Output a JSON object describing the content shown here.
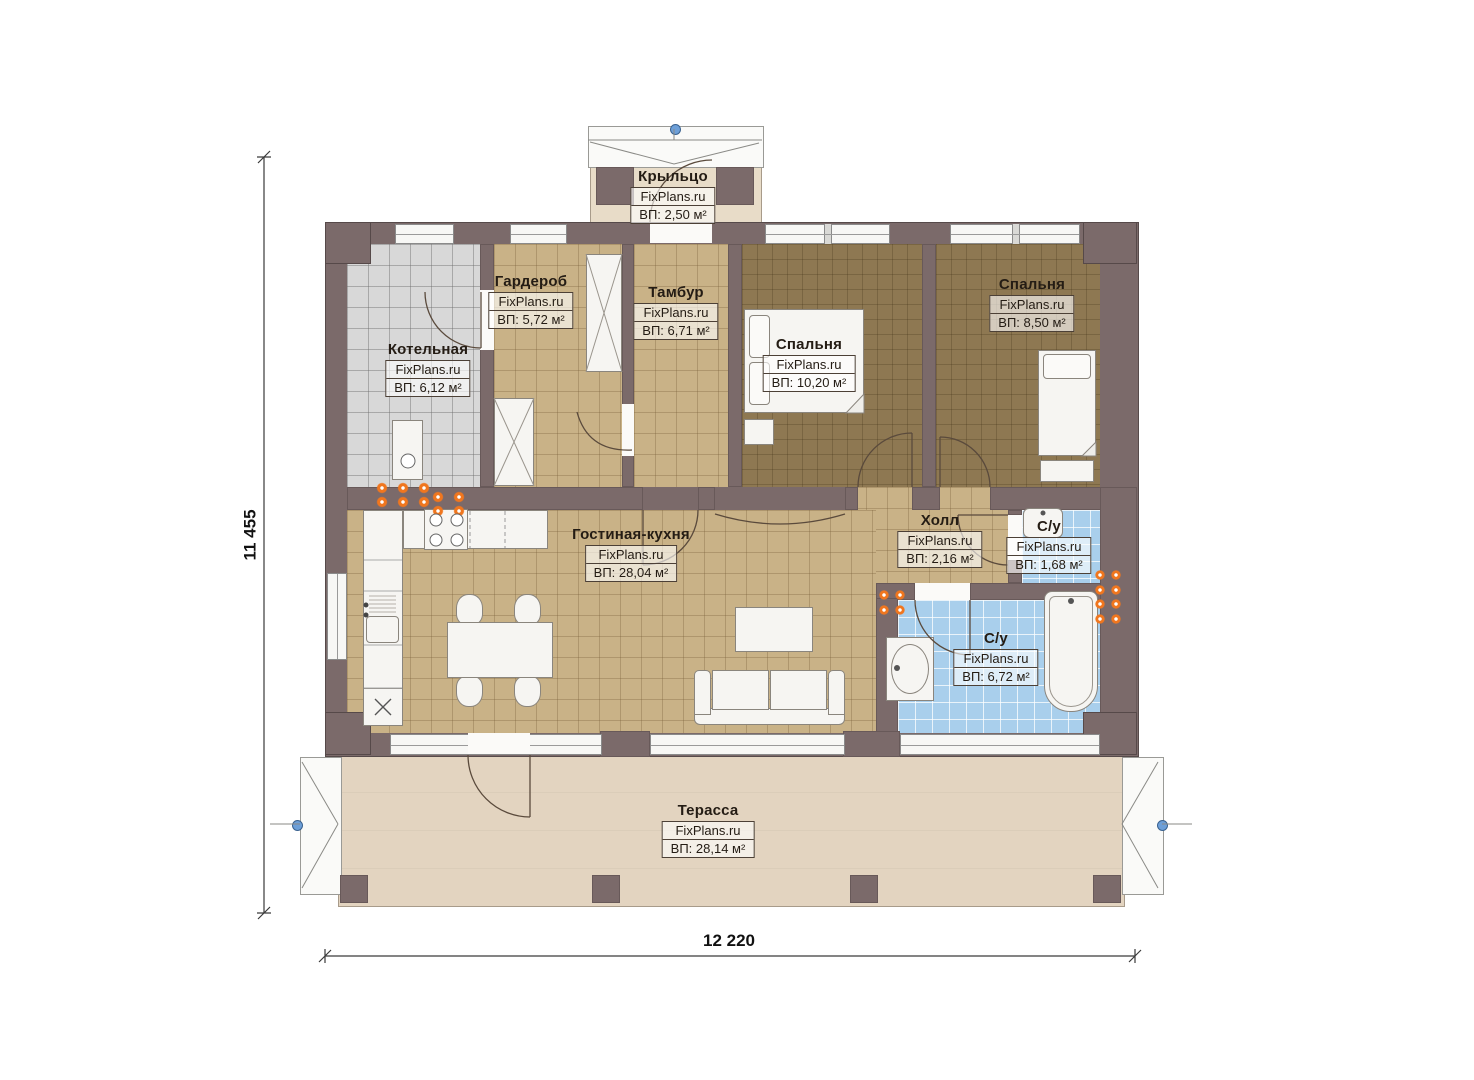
{
  "brand": "FixPlans.ru",
  "dimensions": {
    "height_label": "11 455",
    "width_label": "12 220"
  },
  "rooms": {
    "porch": {
      "name": "Крыльцо",
      "area": "ВП: 2,50 м²"
    },
    "boiler": {
      "name": "Котельная",
      "area": "ВП: 6,12 м²"
    },
    "wardrobe": {
      "name": "Гардероб",
      "area": "ВП: 5,72 м²"
    },
    "vestibule": {
      "name": "Тамбур",
      "area": "ВП: 6,71 м²"
    },
    "bedroom1": {
      "name": "Спальня",
      "area": "ВП: 10,20 м²"
    },
    "bedroom2": {
      "name": "Спальня",
      "area": "ВП: 8,50 м²"
    },
    "living": {
      "name": "Гостиная-кухня",
      "area": "ВП: 28,04 м²"
    },
    "hall": {
      "name": "Холл",
      "area": "ВП: 2,16 м²"
    },
    "wc": {
      "name": "С/у",
      "area": "ВП: 1,68 м²"
    },
    "bathroom": {
      "name": "С/у",
      "area": "ВП: 6,72 м²"
    },
    "terrace": {
      "name": "Терасса",
      "area": "ВП: 28,14 м²"
    }
  },
  "colors": {
    "wall": "#7b6a6a",
    "floor_common": "#c9b287",
    "floor_bedroom": "#8e7852",
    "floor_boiler": "#d8d8d8",
    "floor_bath": "#a9cfec",
    "floor_terrace": "#e3d4c0",
    "floor_porch": "#e8dcc8",
    "radiator": "#f0761e",
    "marker": "#6d9fd8"
  }
}
